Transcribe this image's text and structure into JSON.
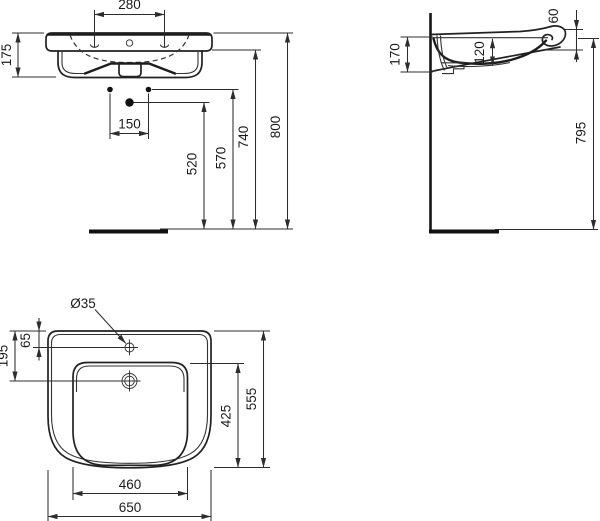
{
  "drawing": {
    "type": "technical-dimension-drawing",
    "subject": "wall-hung washbasin, three orthographic views",
    "colors": {
      "line": "#222222",
      "background": "#ffffff",
      "text": "#1c1c1c"
    },
    "front_view": {
      "dim_tap_holes_spacing": "280",
      "dim_basin_height": "175",
      "dim_fixing_spacing": "150",
      "dim_height_520": "520",
      "dim_height_570": "570",
      "dim_height_740": "740",
      "dim_height_800": "800"
    },
    "side_view": {
      "dim_front_edge": "60",
      "dim_depth_at_wall": "170",
      "dim_inner_depth": "120",
      "dim_height_floor": "795"
    },
    "plan_view": {
      "dim_tap_hole_diameter": "Ø35",
      "dim_tap_hole_offset": "65",
      "dim_overflow_offset": "195",
      "dim_bowl_depth": "425",
      "dim_overall_depth": "555",
      "dim_bowl_width": "460",
      "dim_overall_width": "650"
    }
  }
}
